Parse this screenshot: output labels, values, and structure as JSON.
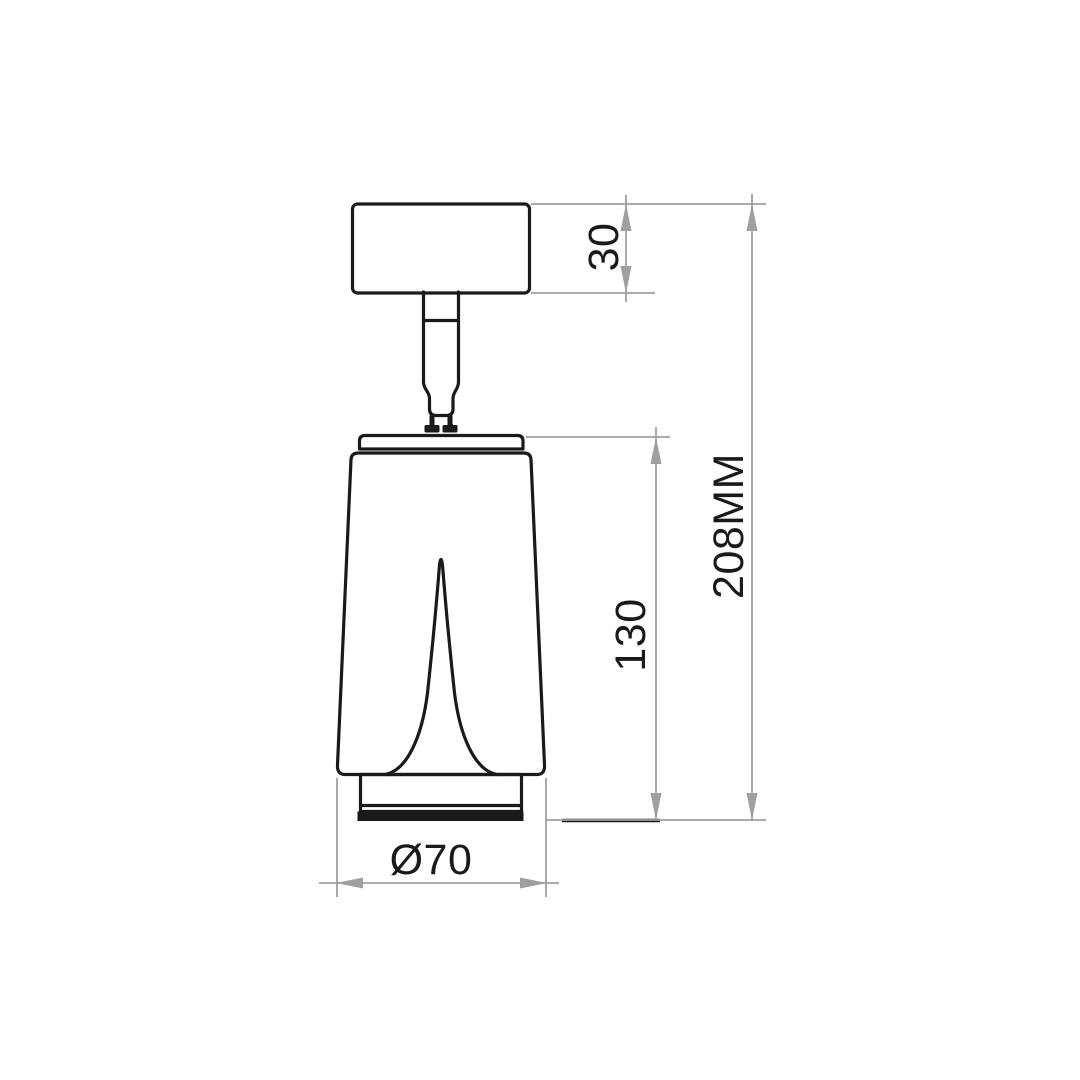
{
  "drawing": {
    "labels": {
      "canopy_height": "30",
      "body_height": "130",
      "overall_height": "208MM",
      "diameter": "Ø70"
    },
    "colors": {
      "outline": "#1a1a1a",
      "dimension_lines": "#9f9f9f",
      "label_text": "#1a1a1a",
      "background": "#ffffff"
    }
  }
}
